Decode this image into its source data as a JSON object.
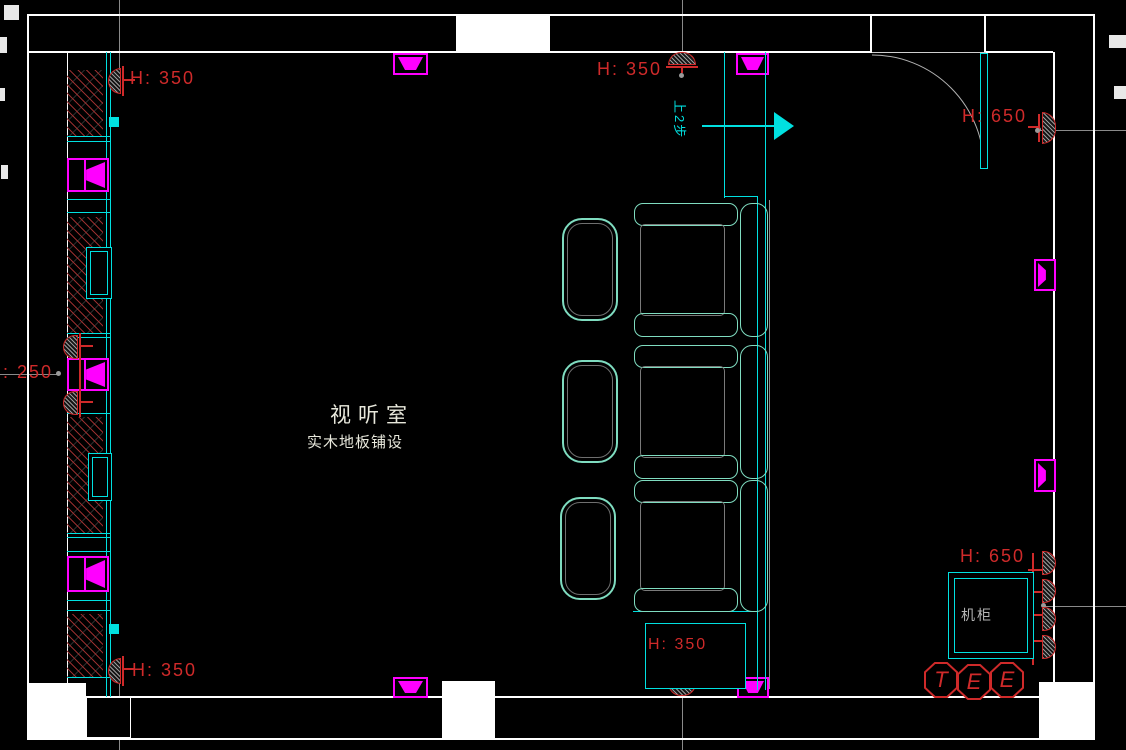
{
  "room": {
    "name": "视听室",
    "floor_note": "实木地板铺设"
  },
  "labels": {
    "height_top_left": "H: 350",
    "height_top_middle": "H: 350",
    "height_top_right": "H: 650",
    "height_left": "H: 250",
    "height_bottom_left": "H: 350",
    "height_subwoofer": "H: 350",
    "height_bottom_right": "H: 650",
    "cabinet": "机柜",
    "step_note": "上2步"
  },
  "tags": {
    "letters": [
      "T",
      "E",
      "E"
    ]
  },
  "colors": {
    "background": "#000000",
    "wall": "#ffffff",
    "fixture_cyan": "#00e0e0",
    "sofa_outline": "#7fdcc0",
    "speaker_magenta": "#ff00ff",
    "annotation_red": "#cf2a2a",
    "grid_gray": "#8a8a8a"
  }
}
